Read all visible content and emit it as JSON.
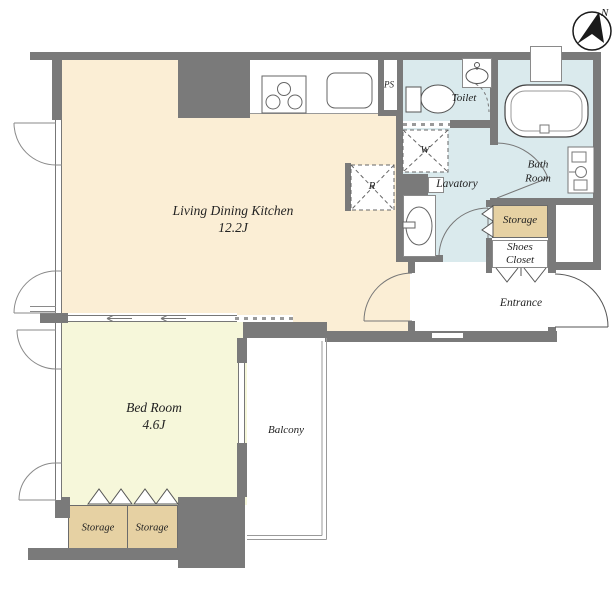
{
  "colors": {
    "wall": "#7a7a7a",
    "ldk_fill": "#fbeed5",
    "bedroom_fill": "#f6f7da",
    "wet_fill": "#daeaed",
    "storage_fill": "#e6d1a3",
    "line": "#777777",
    "text": "#222222"
  },
  "compass": {
    "north_label": "N"
  },
  "rooms": {
    "ldk": {
      "name": "Living Dining Kitchen",
      "size": "12.2J"
    },
    "bedroom": {
      "name": "Bed Room",
      "size": "4.6J"
    },
    "balcony": {
      "name": "Balcony"
    },
    "toilet": {
      "name": "Toilet"
    },
    "bath_room": {
      "name": "Bath Room"
    },
    "lavatory": {
      "name": "Lavatory"
    },
    "entrance": {
      "name": "Entrance"
    },
    "shoes_closet": {
      "name": "Shoes Closet"
    },
    "hall_storage": {
      "name": "Storage"
    },
    "bedroom_storage_left": {
      "name": "Storage"
    },
    "bedroom_storage_right": {
      "name": "Storage"
    }
  },
  "fixtures": {
    "pipe_shaft": {
      "label": "PS"
    },
    "washing_machine": {
      "label": "W"
    },
    "refrigerator": {
      "label": "R"
    }
  }
}
